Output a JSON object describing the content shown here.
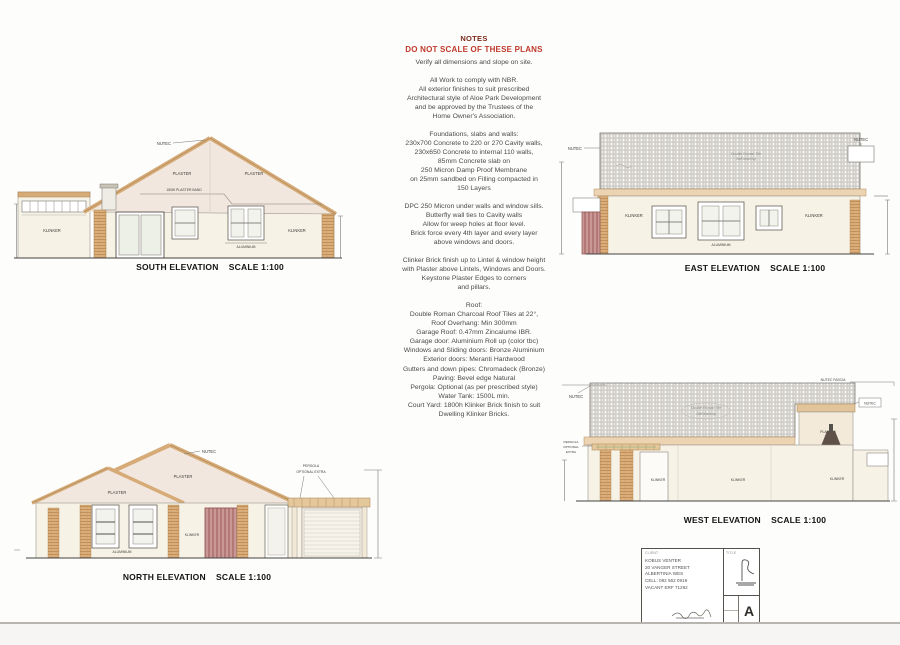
{
  "notes": {
    "title": "NOTES",
    "warning": "DO NOT SCALE OF THESE PLANS",
    "intro": "Verify all dimensions and slope on site.",
    "paragraphs": [
      [
        "All Work to comply with NBR.",
        "All exterior finishes to suit prescribed",
        "Architectural style of Aloe Park Development",
        "and be approved by the Trustees of the",
        "Home Owner's Association."
      ],
      [
        "Foundations, slabs and walls:",
        "230x700 Concrete to 220 or 270 Cavity walls,",
        "230x650 Concrete to internal 110 walls,",
        "85mm Concrete slab on",
        "250 Micron Damp Proof Membrane",
        "on 25mm sandbed on Filling compacted in",
        "150 Layers"
      ],
      [
        "DPC 250 Micron under walls and window sills.",
        "Butterfly wall ties to Cavity walls",
        "Allow for weep holes at floor level.",
        "Brick force every 4th layer and every layer",
        "above windows and doors."
      ],
      [
        "Clinker Brick finish up to Lintel & window height",
        "with Plaster above Lintels, Windows and Doors.",
        "Keystone Plaster Edges to corners",
        "and pillars."
      ],
      [
        "Roof:",
        "Double Roman Charcoal Roof Tiles at 22°,",
        "Roof Overhang: Min 300mm",
        "Garage Roof: 0.47mm Zincalume IBR.",
        "Garage door: Aluminium Roll up (color tbc)",
        "Windows and Sliding doors: Bronze Aluminium",
        "Exterior doors: Meranti Hardwood",
        "Gutters and down pipes: Chromadeck (Bronze)",
        "Paving: Bevel edge Natural",
        "Pergola: Optional (as per prescribed style)",
        "Water Tank: 1500L min.",
        "Court Yard: 1800h Klinker Brick finish to suit",
        "Dwelling Klinker Bricks."
      ]
    ]
  },
  "labels": {
    "nutec": "NUTEC",
    "nutec_fascia": "NUTEC FASCIA",
    "plaster": "PLASTER",
    "plaster_band": "150W PLASTER BAND",
    "klinker": "KLINKER",
    "aluminium": "ALUMINIUM",
    "pergola_line1": "PERGOLA",
    "pergola_line2": "OPTIONAL EXTRA",
    "pergola_l1": "PERGOLA",
    "pergola_l2": "OPTIONAL",
    "pergola_l3": "EXTRA",
    "roof_note_line1": "Double Roman Tile",
    "roof_note_line2": "Self draining"
  },
  "elevations": {
    "south": {
      "caption": "SOUTH ELEVATION    SCALE 1:100"
    },
    "east": {
      "caption": "EAST ELEVATION    SCALE 1:100"
    },
    "north": {
      "caption": "NORTH ELEVATION    SCALE 1:100"
    },
    "west": {
      "caption": "WEST ELEVATION    SCALE 1:100"
    }
  },
  "title_block": {
    "client_header": "CLIENT",
    "client_lines": [
      "KOBUS VENTER",
      "20 VANGER STREET",
      "ALBERTINIA WES",
      "CELL: 082 562 0919",
      "VACANT ERF 71292"
    ],
    "title_header": "TITLE",
    "sheet_letter": "A"
  },
  "colors": {
    "warning_red": "#c0392b",
    "notes_heading": "#7c2a1c",
    "gable_fill": "#f2e7de",
    "wall_fill": "#f7f2e6",
    "roof_edge_tan": "#d6ab77",
    "klinker_tan": "#dcae79",
    "door_red": "#c99795",
    "eave_band": "#ecd3b2"
  }
}
